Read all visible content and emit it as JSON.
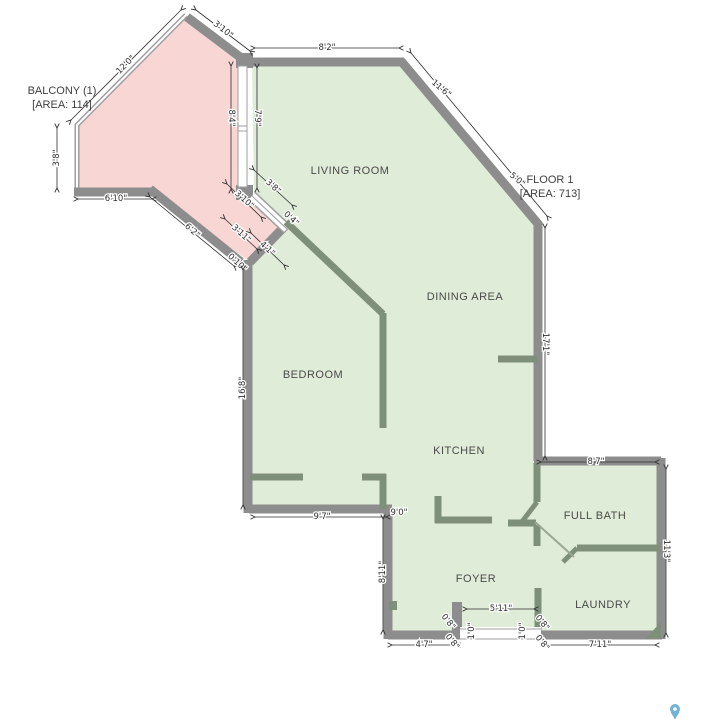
{
  "plan": {
    "balcony": {
      "line1": "BALCONY (1)",
      "line2": "[AREA: 114]"
    },
    "floor": {
      "line1": "FLOOR 1",
      "line2": "[AREA: 713]"
    },
    "rooms": [
      {
        "name": "LIVING ROOM",
        "x": 350,
        "y": 174
      },
      {
        "name": "DINING AREA",
        "x": 465,
        "y": 300
      },
      {
        "name": "BEDROOM",
        "x": 313,
        "y": 378
      },
      {
        "name": "KITCHEN",
        "x": 459,
        "y": 454
      },
      {
        "name": "FULL BATH",
        "x": 595,
        "y": 519
      },
      {
        "name": "FOYER",
        "x": 476,
        "y": 582
      },
      {
        "name": "LAUNDRY",
        "x": 603,
        "y": 608
      }
    ],
    "dimensions": [
      {
        "t": "3'10\"",
        "x": 223,
        "y": 30,
        "r": 38,
        "l": [
          196,
          10,
          250,
          51
        ]
      },
      {
        "t": "8'2\"",
        "x": 327,
        "y": 48,
        "r": 0,
        "l": [
          255,
          48,
          399,
          48
        ]
      },
      {
        "t": "11'6\"",
        "x": 441,
        "y": 89,
        "r": 40,
        "l": [
          411,
          53,
          547,
          216
        ]
      },
      {
        "t": "5'0\"",
        "x": 517,
        "y": 180,
        "r": 40
      },
      {
        "t": "12'0\"",
        "x": 126,
        "y": 65,
        "r": -45,
        "l": [
          71,
          120,
          181,
          10
        ]
      },
      {
        "t": "8'4\"",
        "x": 231,
        "y": 118,
        "r": 90,
        "l": [
          231,
          66,
          231,
          189
        ]
      },
      {
        "t": "7'9\"",
        "x": 257,
        "y": 118,
        "r": 90,
        "l": [
          257,
          68,
          257,
          188
        ]
      },
      {
        "t": "3'8\"",
        "x": 57,
        "y": 158,
        "r": -90,
        "l": [
          57,
          128,
          57,
          188
        ]
      },
      {
        "t": "6'10\"",
        "x": 116,
        "y": 199,
        "r": 0,
        "l": [
          78,
          199,
          152,
          199
        ]
      },
      {
        "t": "6'2\"",
        "x": 192,
        "y": 231,
        "r": 42,
        "l": [
          150,
          197,
          234,
          266
        ]
      },
      {
        "t": "3'8\"",
        "x": 273,
        "y": 187,
        "r": 42,
        "l": [
          254,
          170,
          292,
          205
        ]
      },
      {
        "t": "4'1\"",
        "x": 267,
        "y": 249,
        "r": 42,
        "l": [
          251,
          233,
          284,
          265
        ]
      },
      {
        "t": "0'4\"",
        "x": 291,
        "y": 219,
        "r": 42
      },
      {
        "t": "3'10\"",
        "x": 244,
        "y": 200,
        "r": 42,
        "l": [
          227,
          184,
          261,
          217
        ]
      },
      {
        "t": "3'11\"",
        "x": 241,
        "y": 234,
        "r": 42,
        "l": [
          225,
          219,
          257,
          249
        ]
      },
      {
        "t": "0'10\"",
        "x": 237,
        "y": 263,
        "r": 42
      },
      {
        "t": "16'8\"",
        "x": 243,
        "y": 388,
        "r": -90,
        "l": [
          243,
          270,
          243,
          505
        ]
      },
      {
        "t": "17'1\"",
        "x": 545,
        "y": 344,
        "r": 90,
        "l": [
          545,
          228,
          545,
          456
        ]
      },
      {
        "t": "9'7\"",
        "x": 322,
        "y": 517,
        "r": 0,
        "l": [
          255,
          517,
          386,
          517
        ]
      },
      {
        "t": "9'0\"",
        "x": 399,
        "y": 513,
        "r": 0
      },
      {
        "t": "8'11\"",
        "x": 383,
        "y": 572,
        "r": -90,
        "l": [
          383,
          519,
          383,
          630
        ]
      },
      {
        "t": "8'7\"",
        "x": 596,
        "y": 462,
        "r": 0,
        "l": [
          541,
          462,
          655,
          462
        ]
      },
      {
        "t": "11'3\"",
        "x": 666,
        "y": 551,
        "r": 90,
        "l": [
          666,
          469,
          666,
          633
        ]
      },
      {
        "t": "7'11\"",
        "x": 600,
        "y": 645,
        "r": 0,
        "l": [
          546,
          645,
          655,
          645
        ]
      },
      {
        "t": "4'7\"",
        "x": 424,
        "y": 645,
        "r": 0,
        "l": [
          392,
          645,
          456,
          645
        ]
      },
      {
        "t": "5'11\"",
        "x": 501,
        "y": 609,
        "r": 0,
        "l": [
          467,
          609,
          534,
          609
        ]
      },
      {
        "t": "0'8\"",
        "x": 448,
        "y": 622,
        "r": 52
      },
      {
        "t": "0'8\"",
        "x": 452,
        "y": 642,
        "r": 52
      },
      {
        "t": "1'0\"",
        "x": 472,
        "y": 631,
        "r": -90
      },
      {
        "t": "1'0\"",
        "x": 523,
        "y": 631,
        "r": -90
      },
      {
        "t": "0'8\"",
        "x": 542,
        "y": 623,
        "r": 52
      },
      {
        "t": "0'8\"",
        "x": 542,
        "y": 643,
        "r": 52
      }
    ],
    "colors": {
      "floor_fill": "#dfecd8",
      "balcony_fill": "#f8d6d4",
      "outer_wall": "#8d8d8d",
      "interior_wall": "#7e8f7a",
      "window_casing": "#9f9f9f",
      "dim_text": "#2e2e2e",
      "pin": "#74b3d4"
    },
    "icon": {
      "name": "map-pin-icon"
    }
  }
}
